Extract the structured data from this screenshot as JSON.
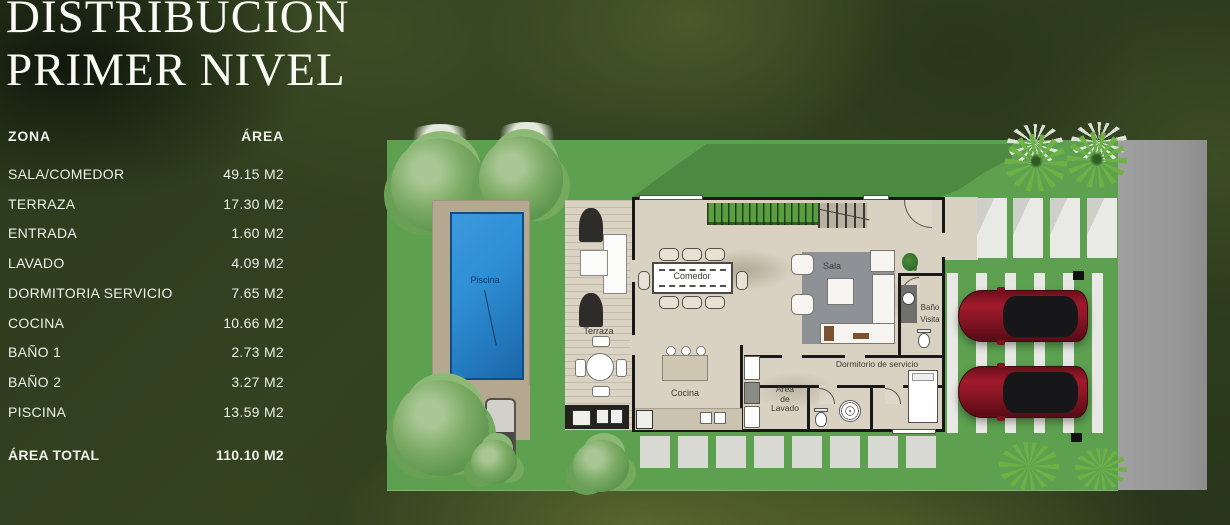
{
  "title": {
    "line1": "DISTRIBUCION",
    "line2": "PRIMER NIVEL"
  },
  "table": {
    "headers": {
      "zone": "ZONA",
      "area": "ÁREA"
    },
    "rows": [
      {
        "zone": "SALA/COMEDOR",
        "area": "49.15 M2"
      },
      {
        "zone": "TERRAZA",
        "area": "17.30 M2"
      },
      {
        "zone": "ENTRADA",
        "area": "1.60 M2"
      },
      {
        "zone": "LAVADO",
        "area": "4.09 M2"
      },
      {
        "zone": "DORMITORIA SERVICIO",
        "area": "7.65 M2"
      },
      {
        "zone": "COCINA",
        "area": "10.66 M2"
      },
      {
        "zone": "BAÑO 1",
        "area": "2.73 M2"
      },
      {
        "zone": "BAÑO 2",
        "area": "3.27 M2"
      },
      {
        "zone": "PISCINA",
        "area": "13.59 M2"
      }
    ],
    "total": {
      "zone": "ÁREA TOTAL",
      "area": "110.10 M2"
    }
  },
  "floorplan": {
    "labels": {
      "pool": "Piscina",
      "terrace": "Terraza",
      "dining": "Comedor",
      "living": "Sala",
      "kitchen": "Cocina",
      "guest_bath_lines": [
        "Baño",
        "Visita"
      ],
      "laundry_lines": [
        "Area",
        "de",
        "Lavado"
      ],
      "service_bedroom": "Dormitorio de servicio"
    },
    "colors": {
      "grass": "#5ca050",
      "grass_shadow": "#4c8a42",
      "pool_water": "#2f8fd4",
      "street": "#9b9b9b",
      "deck": "#b5a891",
      "house_floor": "#d9d1c1",
      "car_body": "#8a1626",
      "background_foliage": "#27331a"
    }
  }
}
